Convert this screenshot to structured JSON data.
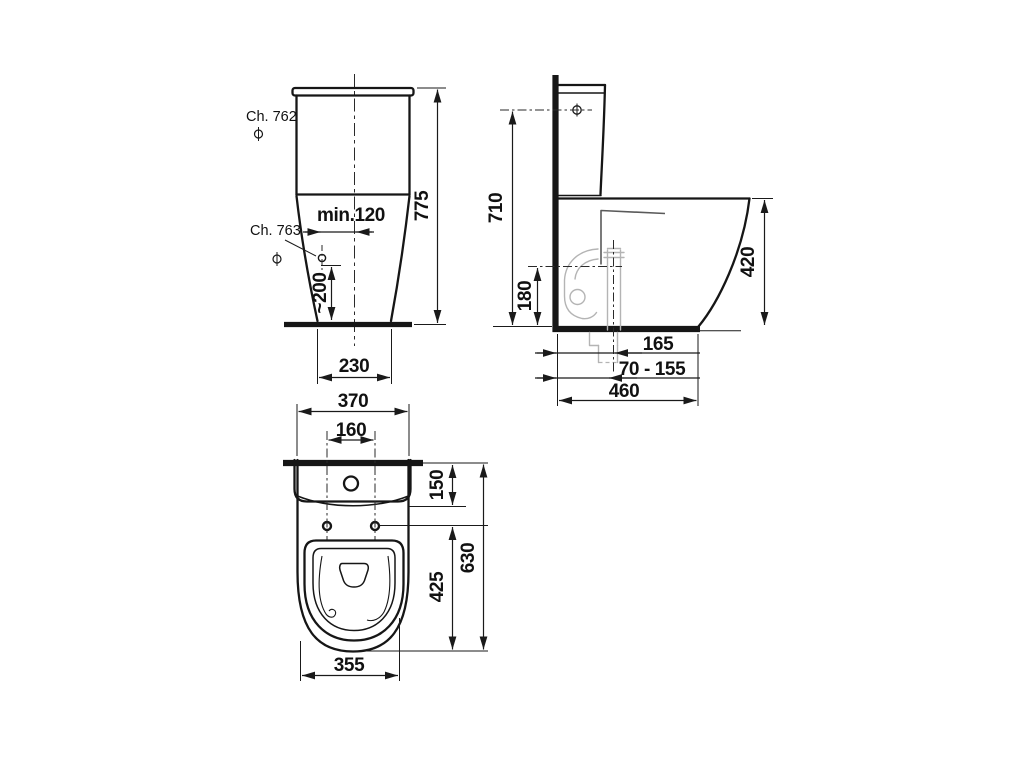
{
  "drawing": {
    "front_view": {
      "ref_ch762": "Ch. 762",
      "ref_ch763": "Ch. 763",
      "dim_hole_offset": "min.120",
      "dim_hole_height": "~200",
      "dim_total_height": "775",
      "dim_base_width": "230"
    },
    "side_view": {
      "dim_inlet_height": "710",
      "dim_outlet_height": "180",
      "dim_bowl_height": "420",
      "dim_outlet_offset": "165",
      "dim_outlet_range": "70 - 155",
      "dim_depth": "460"
    },
    "top_view": {
      "dim_width": "370",
      "dim_seat_hole_spacing": "160",
      "dim_tank_depth": "150",
      "dim_holes_to_front": "425",
      "dim_total_depth": "630",
      "dim_bowl_width": "355"
    },
    "colors": {
      "line": "#161616",
      "dimension": "#1a1a1a",
      "hidden_parts": "#b4b4b4",
      "section_line": "#5a5a5a",
      "background": "#ffffff"
    }
  }
}
